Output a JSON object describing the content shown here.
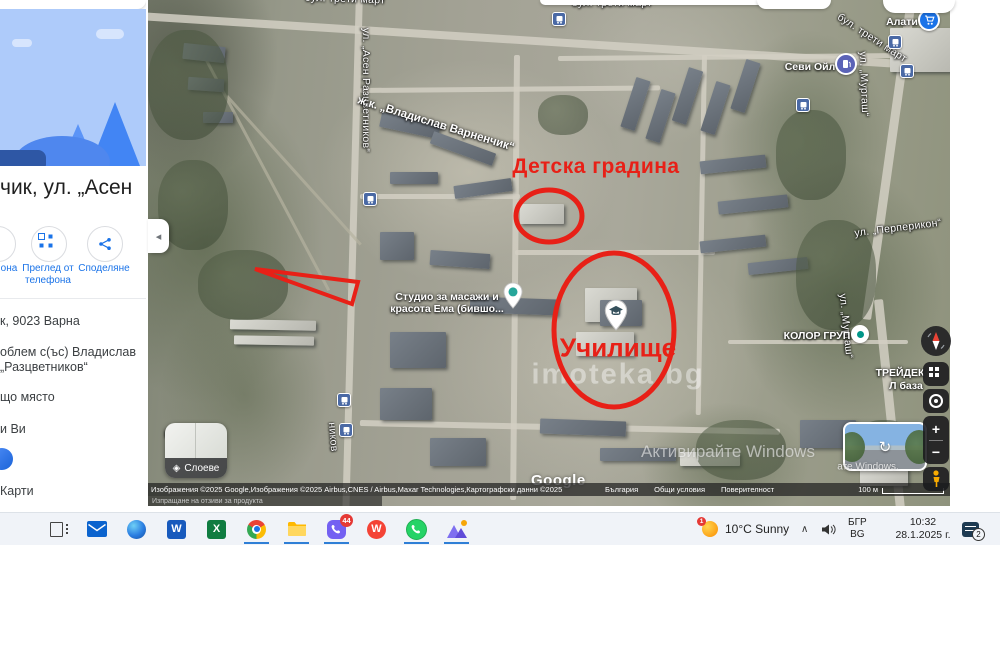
{
  "sidebar": {
    "title": "чик, ул. „Асен",
    "actions": [
      {
        "label": "она"
      },
      {
        "label": "Преглед от телефона"
      },
      {
        "label": "Споделяне"
      }
    ],
    "address": "к, 9023 Варна",
    "claim_line1": "облем с(ъс) Владислав",
    "claim_line2": "„Разцветников“",
    "missing_place": "що място",
    "for_you": "и Ви",
    "maps_link": "Карти"
  },
  "ui": {
    "collapse_arrow": "◂",
    "layers_label": "Слоеве",
    "layers_icon": "◈",
    "zoom_in": "+",
    "zoom_out": "−",
    "street_view_icon": "↻"
  },
  "map": {
    "google_logo": "Google",
    "attribution": "Изображения ©2025 Google,Изображения ©2025 Airbus,CNES / Airbus,Maxar Technologies,Картографски данни ©2025",
    "attribution_links": [
      "България",
      "Общи условия",
      "Поверителност"
    ],
    "scale": "100 м",
    "feedback": "Изпращане на отзиви за продукта",
    "labels": [
      {
        "t": "бул. трети март",
        "x": 345,
        "y": -1,
        "r": 2,
        "c": "street"
      },
      {
        "t": "бул. трети март",
        "x": 612,
        "y": 3,
        "r": 0,
        "c": "street"
      },
      {
        "t": "бул. трети март",
        "x": 872,
        "y": 38,
        "r": 33,
        "c": "street"
      },
      {
        "t": "ул. „Асен Разцветников“",
        "x": 366,
        "y": 90,
        "r": 90,
        "c": "street"
      },
      {
        "t": "ж.к. „Владислав Варненчик“",
        "x": 436,
        "y": 124,
        "r": 17,
        "c": "street-big"
      },
      {
        "t": "ул. „Мургаш“",
        "x": 864,
        "y": 84,
        "r": 88,
        "c": "street"
      },
      {
        "t": "ул. „Мургаш“",
        "x": 846,
        "y": 326,
        "r": 84,
        "c": "street"
      },
      {
        "t": "ул. „Перперикон“",
        "x": 898,
        "y": 228,
        "r": -7,
        "c": "street"
      },
      {
        "t": "ников",
        "x": 333,
        "y": 437,
        "r": 85,
        "c": "street"
      },
      {
        "t": "Алати",
        "x": 902,
        "y": 22,
        "r": 0,
        "c": "poi"
      },
      {
        "t": "Севи Ойл",
        "x": 810,
        "y": 67,
        "r": 0,
        "c": "poi"
      },
      {
        "t": "Студио за масажи и",
        "x": 447,
        "y": 297,
        "r": 0,
        "c": "poi"
      },
      {
        "t": "красота Ема (бившо...",
        "x": 447,
        "y": 309,
        "r": 0,
        "c": "poi"
      },
      {
        "t": "КОЛОР ГРУП",
        "x": 817,
        "y": 336,
        "r": 0,
        "c": "poi"
      },
      {
        "t": "ТРЕЙДЕК",
        "x": 900,
        "y": 373,
        "r": 0,
        "c": "poi"
      },
      {
        "t": "Л база",
        "x": 906,
        "y": 386,
        "r": 0,
        "c": "poi"
      },
      {
        "t": "Ре",
        "x": 171,
        "y": 434,
        "r": 0,
        "c": "poi"
      },
      {
        "t": "Детска градина",
        "x": 596,
        "y": 167,
        "r": 0,
        "c": "red-big"
      },
      {
        "t": "Училище",
        "x": 618,
        "y": 348,
        "r": 0,
        "c": "red-huge"
      },
      {
        "t": "imoteka.bg",
        "x": 618,
        "y": 375,
        "r": 0,
        "c": "wm-big"
      }
    ],
    "watermarks": [
      {
        "t": "Активирайте Windows",
        "x": 728,
        "y": 452,
        "c": "wm"
      },
      {
        "t": "ате Windows.",
        "x": 868,
        "y": 467,
        "c": "wm-small"
      }
    ],
    "markers": [
      {
        "type": "bus",
        "x": 370,
        "y": 199
      },
      {
        "type": "bus",
        "x": 344,
        "y": 400
      },
      {
        "type": "bus",
        "x": 346,
        "y": 430
      },
      {
        "type": "bus",
        "x": 559,
        "y": 19
      },
      {
        "type": "bus",
        "x": 895,
        "y": 42
      },
      {
        "type": "bus",
        "x": 907,
        "y": 71
      },
      {
        "type": "bus",
        "x": 803,
        "y": 105
      },
      {
        "type": "pin-school",
        "x": 616,
        "y": 336
      },
      {
        "type": "pin-dot",
        "x": 513,
        "y": 314
      },
      {
        "type": "dot",
        "x": 860,
        "y": 334
      },
      {
        "type": "cart",
        "x": 929,
        "y": 20
      },
      {
        "type": "fuel",
        "x": 846,
        "y": 64
      }
    ],
    "annotations": {
      "color": "#e82017",
      "ellipses": [
        {
          "cx": 549,
          "cy": 216,
          "rx": 33,
          "ry": 26,
          "w": 5
        },
        {
          "cx": 614,
          "cy": 330,
          "rx": 60,
          "ry": 77,
          "w": 5
        }
      ],
      "triangle": {
        "points": "255,269 358,282 352,304",
        "w": 4
      }
    }
  },
  "taskbar": {
    "viber_badge": "44",
    "weather_badge": "1",
    "weather": "10°C Sunny",
    "chevron": "∧",
    "language_line1": "БГР",
    "language_line2": "BG",
    "time": "10:32",
    "date": "28.1.2025 г.",
    "notification_badge": "2"
  }
}
